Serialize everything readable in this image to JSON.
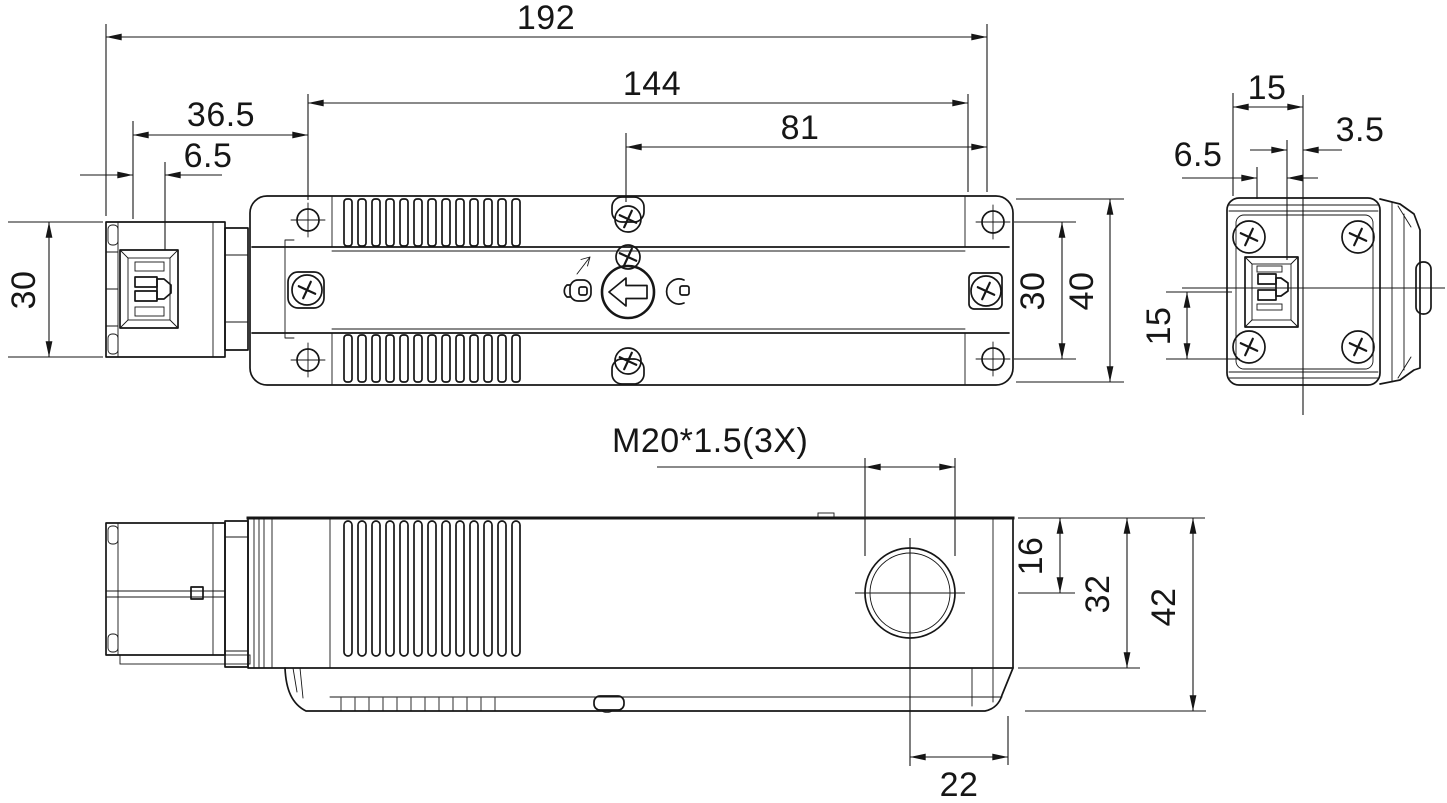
{
  "colors": {
    "line": "#161616",
    "background": "#ffffff"
  },
  "icons": {
    "dial": "left-arrow-release-dial-icon",
    "left": "padlock-icon",
    "right": "hook-icon",
    "pointer": "small-arrow-icon"
  },
  "dims": {
    "total_length": "192",
    "mount_length": "144",
    "span_right": "81",
    "head_length": "36.5",
    "head_slot_offset": "6.5",
    "head_height": "30",
    "hole_spacing": "30",
    "body_width": "40",
    "end_width": "15",
    "end_offset_right": "3.5",
    "end_offset_left": "6.5",
    "end_half_height": "15",
    "gland_thread": "M20*1.5(3X)",
    "gland_center_from_top": "16",
    "side_body_height": "32",
    "side_total_height": "42",
    "gland_center_from_edge": "22"
  }
}
